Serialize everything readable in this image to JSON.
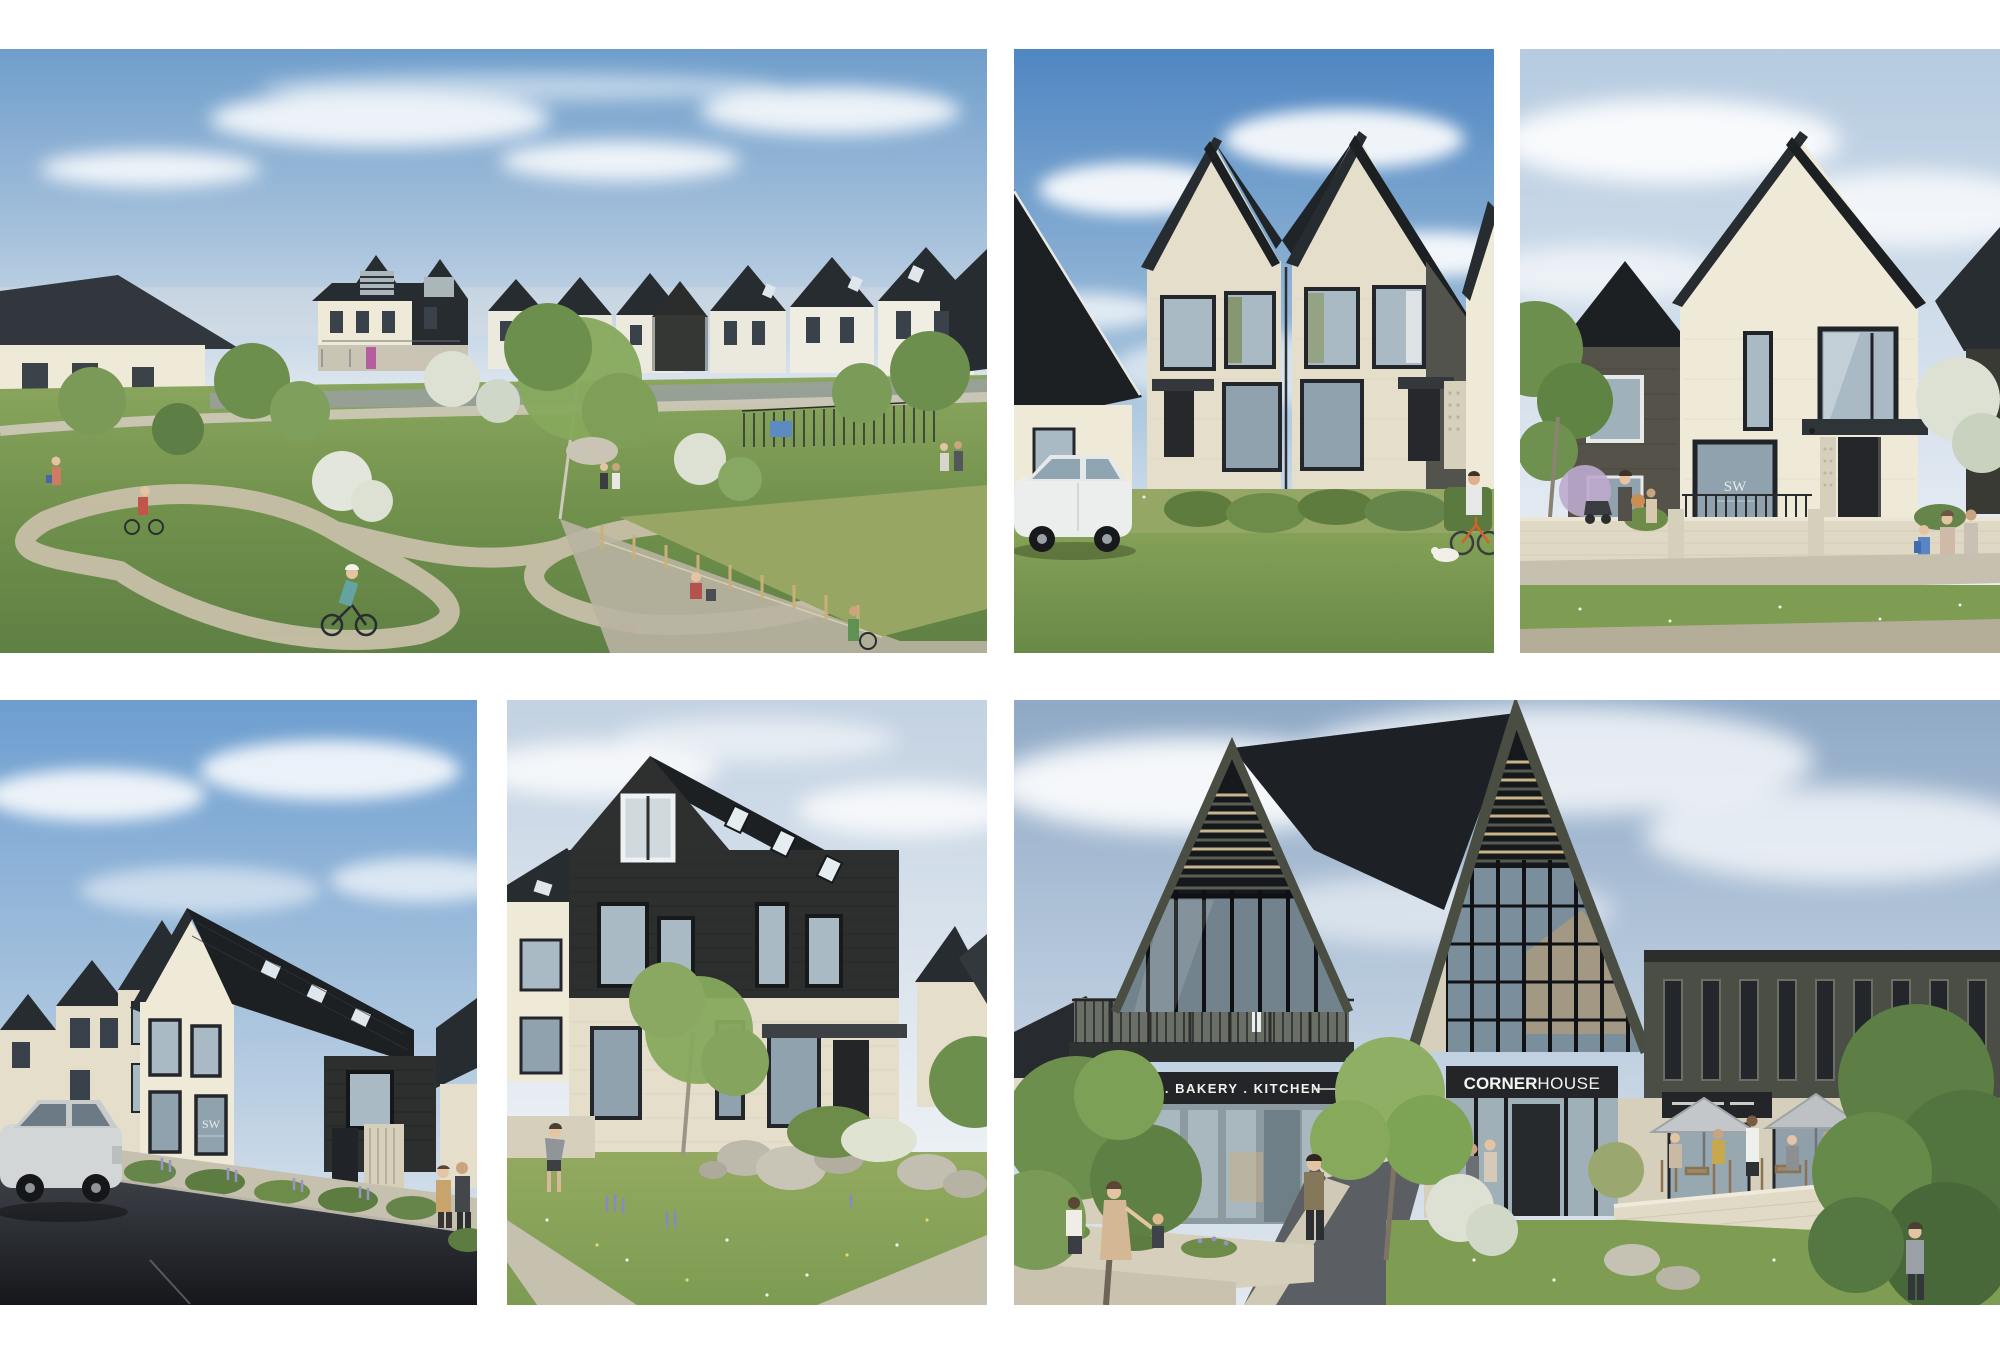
{
  "page": {
    "kind": "property development photo collage",
    "background_color": "#ffffff"
  },
  "gallery": {
    "images": [
      {
        "position": "top-left",
        "name": "masterplan-park-view",
        "alt": "Landscaped park with winding pump-track paths, cyclists and families, rows of new gabled houses and twin-gabled apartment buildings beyond"
      },
      {
        "position": "top-middle",
        "name": "semi-detached-pair",
        "alt": "Pair of cream brick semi-detached houses with steep dark gable roofs, white SUV parked outside and wildflower verge"
      },
      {
        "position": "top-right",
        "name": "detached-house",
        "alt": "Detached cream brick gabled house beside a charcoal brick house, low garden wall with railings and families walking past"
      },
      {
        "position": "bottom-left",
        "name": "terrace-parking-court",
        "alt": "Terrace of gabled brick houses with a black clad corner beside a dark parking court with a silver SUV"
      },
      {
        "position": "bottom-middle",
        "name": "black-clad-townhouse",
        "alt": "Three storey black timber clad house over a pale brick ground floor with boulders and wildflower meadow garden"
      },
      {
        "position": "bottom-right",
        "name": "cornerhouse-cafe",
        "alt": "CornerHouse cafe building with twin louvred glass gables, coffee bakery kitchen shopfront and busy outdoor terrace"
      }
    ]
  },
  "signs": {
    "cafe_fascia": "COFFEE . BAKERY . KITCHEN",
    "cornerhouse_bold": "CORNER",
    "cornerhouse_light": "HOUSE",
    "show_home_plaque": "SW"
  },
  "colors": {
    "background": "#ffffff",
    "sky_deep": "#5d8fc4",
    "sky_pale": "#c9d8e8",
    "cloud": "#f4f7fa",
    "cream_brick": "#e4decb",
    "dark_roof": "#272c31",
    "black_cladding": "#2c2f2e",
    "olive_metal": "#4b4e45",
    "glass": "#a9bac4",
    "grass": "#7e9c52",
    "meadow": "#95a765",
    "asphalt": "#1b1d22",
    "path": "#c6c0af",
    "sign_band": "#232528",
    "sign_text": "#f4f4f0"
  }
}
